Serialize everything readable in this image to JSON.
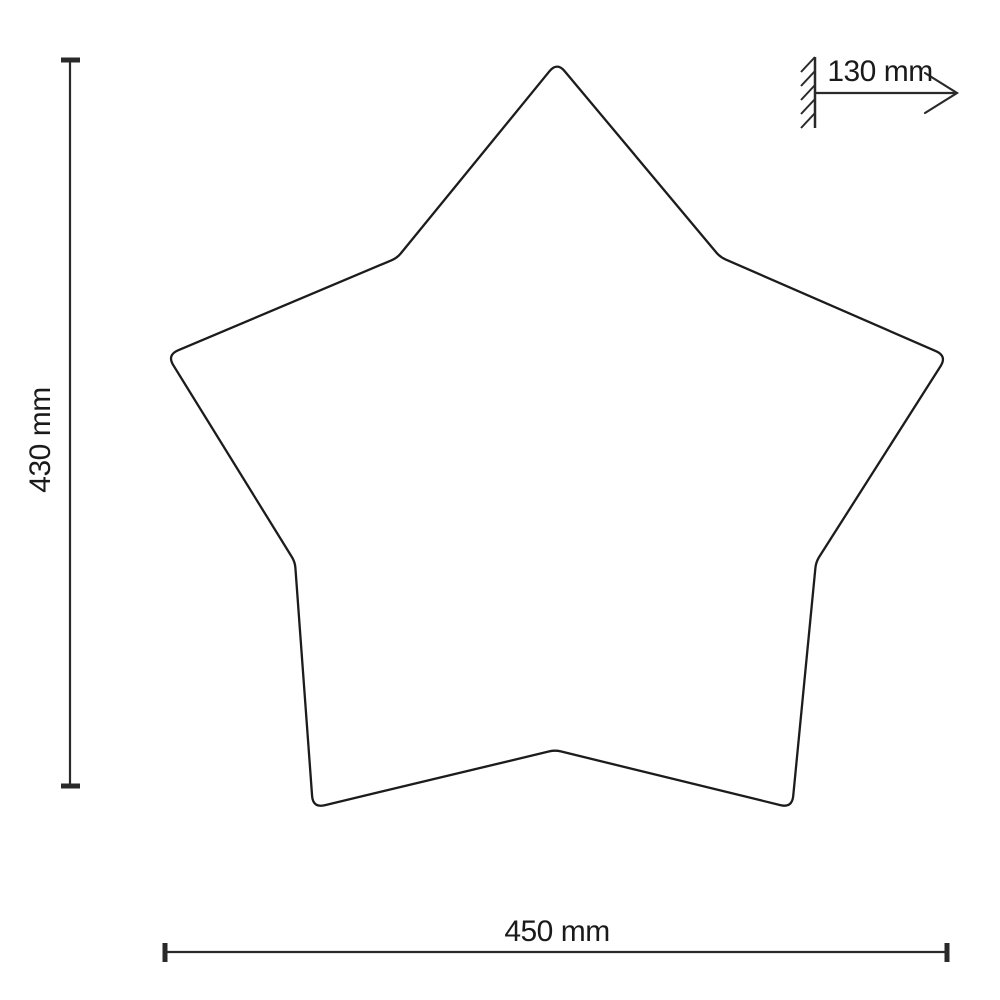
{
  "page": {
    "background_color": "#ffffff",
    "line_color": "#222222",
    "text_color": "#1a1a1a"
  },
  "drawing": {
    "description": "Technical dimension drawing of a five-pointed star shaped wall lamp",
    "dimensions": {
      "height_label": "430 mm",
      "width_label": "450 mm",
      "depth_label": "130 mm"
    },
    "star_points": [
      [
        557,
        62
      ],
      [
        720,
        257
      ],
      [
        947,
        356
      ],
      [
        816,
        562
      ],
      [
        792,
        808
      ],
      [
        555,
        750
      ],
      [
        313,
        808
      ],
      [
        295,
        562
      ],
      [
        167,
        355
      ],
      [
        397,
        258
      ]
    ],
    "corner_radii": [
      12,
      6,
      12,
      6,
      12,
      6,
      12,
      6,
      12,
      6
    ]
  }
}
